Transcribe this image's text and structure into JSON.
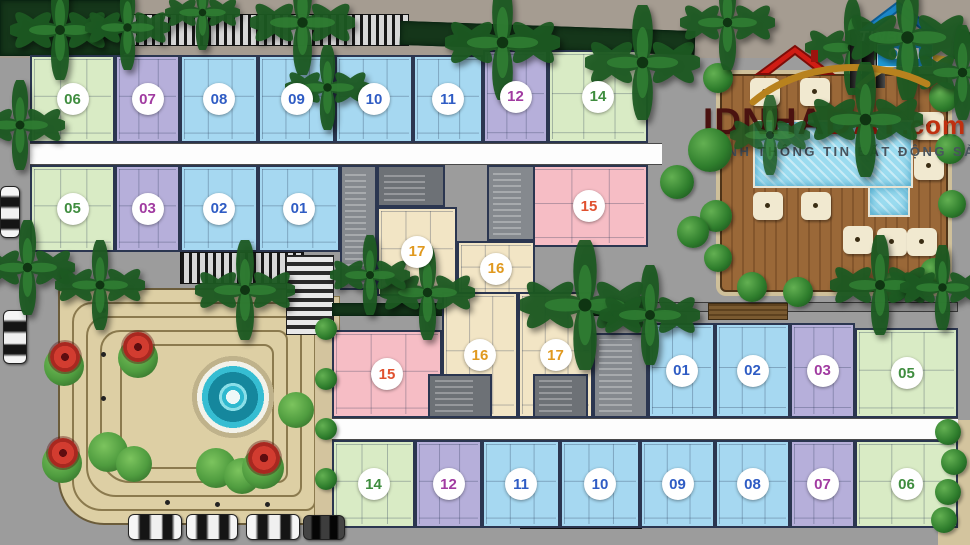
{
  "watermarks": {
    "tinbds": {
      "line1": "TINBD",
      "line2": "OM"
    },
    "idnhadat": {
      "brand_dark": "IDNHA",
      "brand_red": "DAT",
      "brand_domain": ".com",
      "dash_left": "—",
      "tagline": "NH THÔNG TIN BẤT ĐỘNG SẢN",
      "dash_right": "—"
    }
  },
  "buildings": {
    "top": {
      "units": [
        {
          "number": "06",
          "type": "green"
        },
        {
          "number": "07",
          "type": "purple"
        },
        {
          "number": "08",
          "type": "blue"
        },
        {
          "number": "09",
          "type": "blue"
        },
        {
          "number": "10",
          "type": "blue"
        },
        {
          "number": "11",
          "type": "blue"
        },
        {
          "number": "12",
          "type": "purple"
        },
        {
          "number": "14",
          "type": "green"
        },
        {
          "number": "05",
          "type": "green"
        },
        {
          "number": "03",
          "type": "purple"
        },
        {
          "number": "02",
          "type": "blue"
        },
        {
          "number": "01",
          "type": "blue"
        },
        {
          "number": "15",
          "type": "pink"
        },
        {
          "number": "17",
          "type": "beige"
        },
        {
          "number": "16",
          "type": "beige"
        }
      ]
    },
    "bottom": {
      "units": [
        {
          "number": "15",
          "type": "pink"
        },
        {
          "number": "16",
          "type": "beige"
        },
        {
          "number": "17",
          "type": "beige"
        },
        {
          "number": "01",
          "type": "blue"
        },
        {
          "number": "02",
          "type": "blue"
        },
        {
          "number": "03",
          "type": "purple"
        },
        {
          "number": "05",
          "type": "green"
        },
        {
          "number": "14",
          "type": "green"
        },
        {
          "number": "12",
          "type": "purple"
        },
        {
          "number": "11",
          "type": "blue"
        },
        {
          "number": "10",
          "type": "blue"
        },
        {
          "number": "09",
          "type": "blue"
        },
        {
          "number": "08",
          "type": "blue"
        },
        {
          "number": "07",
          "type": "purple"
        },
        {
          "number": "06",
          "type": "green"
        }
      ]
    }
  },
  "colors": {
    "unit_green": "#d9ebc5",
    "unit_blue": "#a6d8f1",
    "unit_purple": "#b6afda",
    "unit_pink": "#f6bdc5",
    "unit_beige": "#f2e5c5",
    "pool": "#9adbef",
    "deck": "#9a6838",
    "plaza": "#ddcfa4",
    "road": "#9c9c9c"
  }
}
